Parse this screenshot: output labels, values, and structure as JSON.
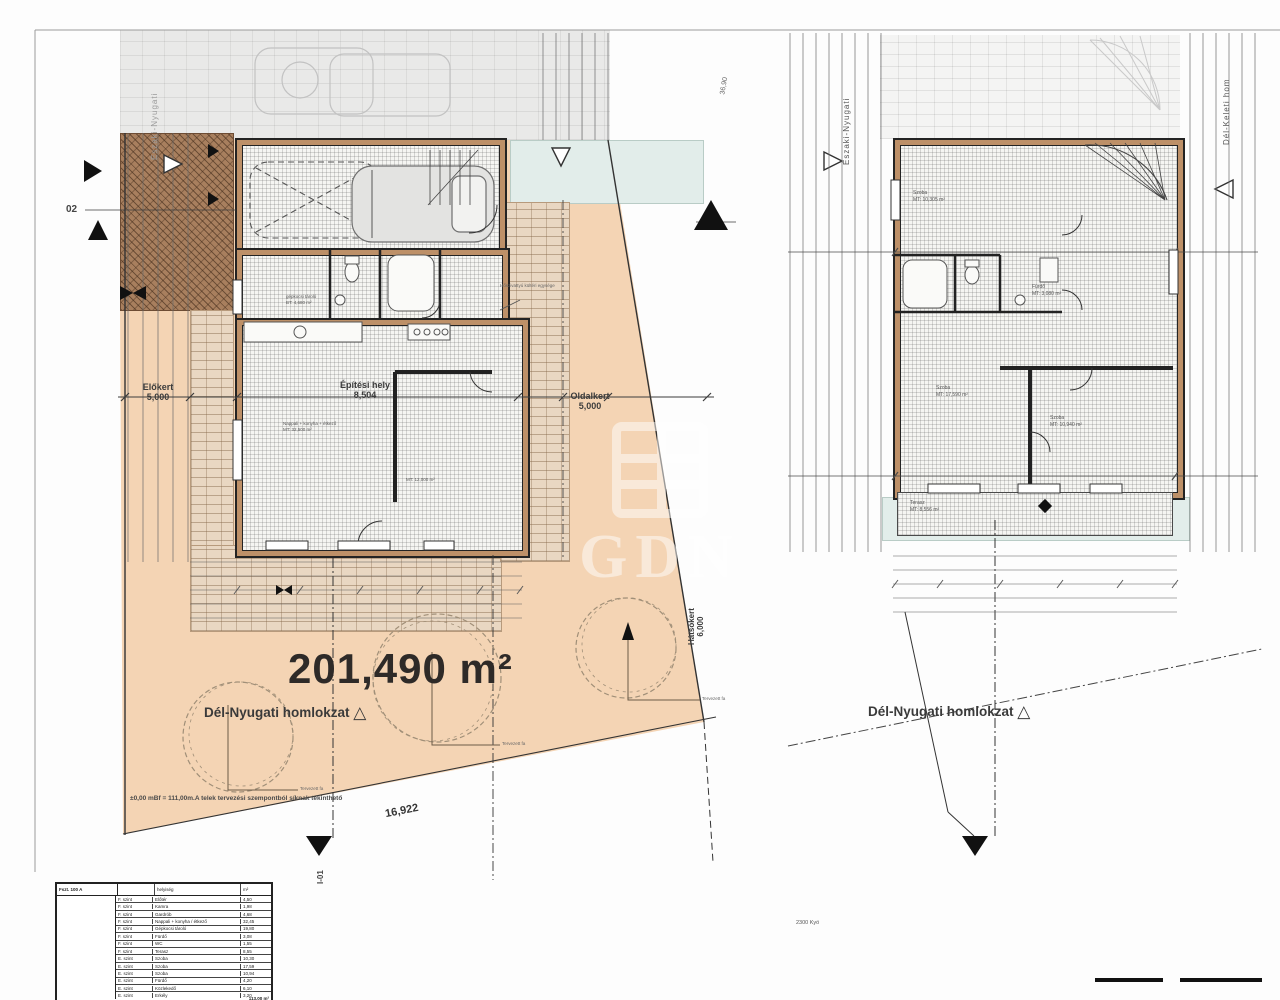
{
  "watermark": {
    "letters": "GDN"
  },
  "site_plan": {
    "area_label": "201,490 m²",
    "facade_label": "Dél-Nyugati homlokzat",
    "section_label": "I-01",
    "elevation_marker_label": "02",
    "edge_label": "Északi-Nyugati",
    "top_dim": "36,90",
    "front_yard_label": "Előkert",
    "front_yard_value": "5,000",
    "building_zone_label": "Építési hely",
    "building_zone_value": "8,504",
    "side_yard_label": "Oldalkert",
    "side_yard_value": "5,000",
    "rear_yard_label": "Hátsókert",
    "rear_yard_value": "6,000",
    "boundary_length": "16,922",
    "level_note": "±0,00 mBf = 111,00m.A telek tervezési szempontból síknak tekinthető",
    "heat_pump_note": "Hőszivattyú kültéri egysége",
    "tree_label": "Tervezett fa",
    "garage_room": {
      "name": "gépkocsi tároló",
      "area": "BT: 4,680 m²"
    },
    "living_room": {
      "name": "Nappali + konyha + étkező",
      "area": "MT: 32,500 m²"
    },
    "extra_room_area": "MT: 12,000 m²"
  },
  "upper_plan": {
    "facade_label": "Dél-Nyugati homlokzat",
    "edge_label_left": "Északi-Nyugati",
    "edge_label_right": "Dél-Keleti hom",
    "bottom_note": "2300 Kyö",
    "rooms": {
      "bedroom1": {
        "name": "Szoba",
        "area": "MT: 10,305 m²"
      },
      "bath": {
        "name": "Fürdő",
        "area": "MT: 3,080 m²"
      },
      "bedroom2": {
        "name": "Szoba",
        "area": "MT: 17,590 m²"
      },
      "bedroom3": {
        "name": "Szoba",
        "area": "MT: 10,940 m²"
      },
      "terrace": {
        "name": "Terasz",
        "area": "MT: 8,556 m²"
      }
    }
  },
  "room_schedule": {
    "title": "Fszt. 100 A",
    "col_room": "helyiség",
    "col_area": "m²",
    "rows": [
      [
        "F. szint",
        "Előtér",
        "4,50"
      ],
      [
        "F. szint",
        "Kamra",
        "1,98"
      ],
      [
        "F. szint",
        "Gardrób",
        "4,68"
      ],
      [
        "F. szint",
        "Nappali + konyha / étkező",
        "32,45"
      ],
      [
        "F. szint",
        "Gépkocsi tároló",
        "19,80"
      ],
      [
        "F. szint",
        "Fürdő",
        "3,08"
      ],
      [
        "F. szint",
        "WC",
        "1,55"
      ],
      [
        "F. szint",
        "Terasz",
        "8,55"
      ],
      [
        "E. szint",
        "Szoba",
        "10,30"
      ],
      [
        "E. szint",
        "Szoba",
        "17,59"
      ],
      [
        "E. szint",
        "Szoba",
        "10,94"
      ],
      [
        "E. szint",
        "Fürdő",
        "4,20"
      ],
      [
        "E. szint",
        "Közlekedő",
        "6,10"
      ],
      [
        "E. szint",
        "Erkély",
        "3,20"
      ]
    ],
    "total": "113,00 m²"
  }
}
